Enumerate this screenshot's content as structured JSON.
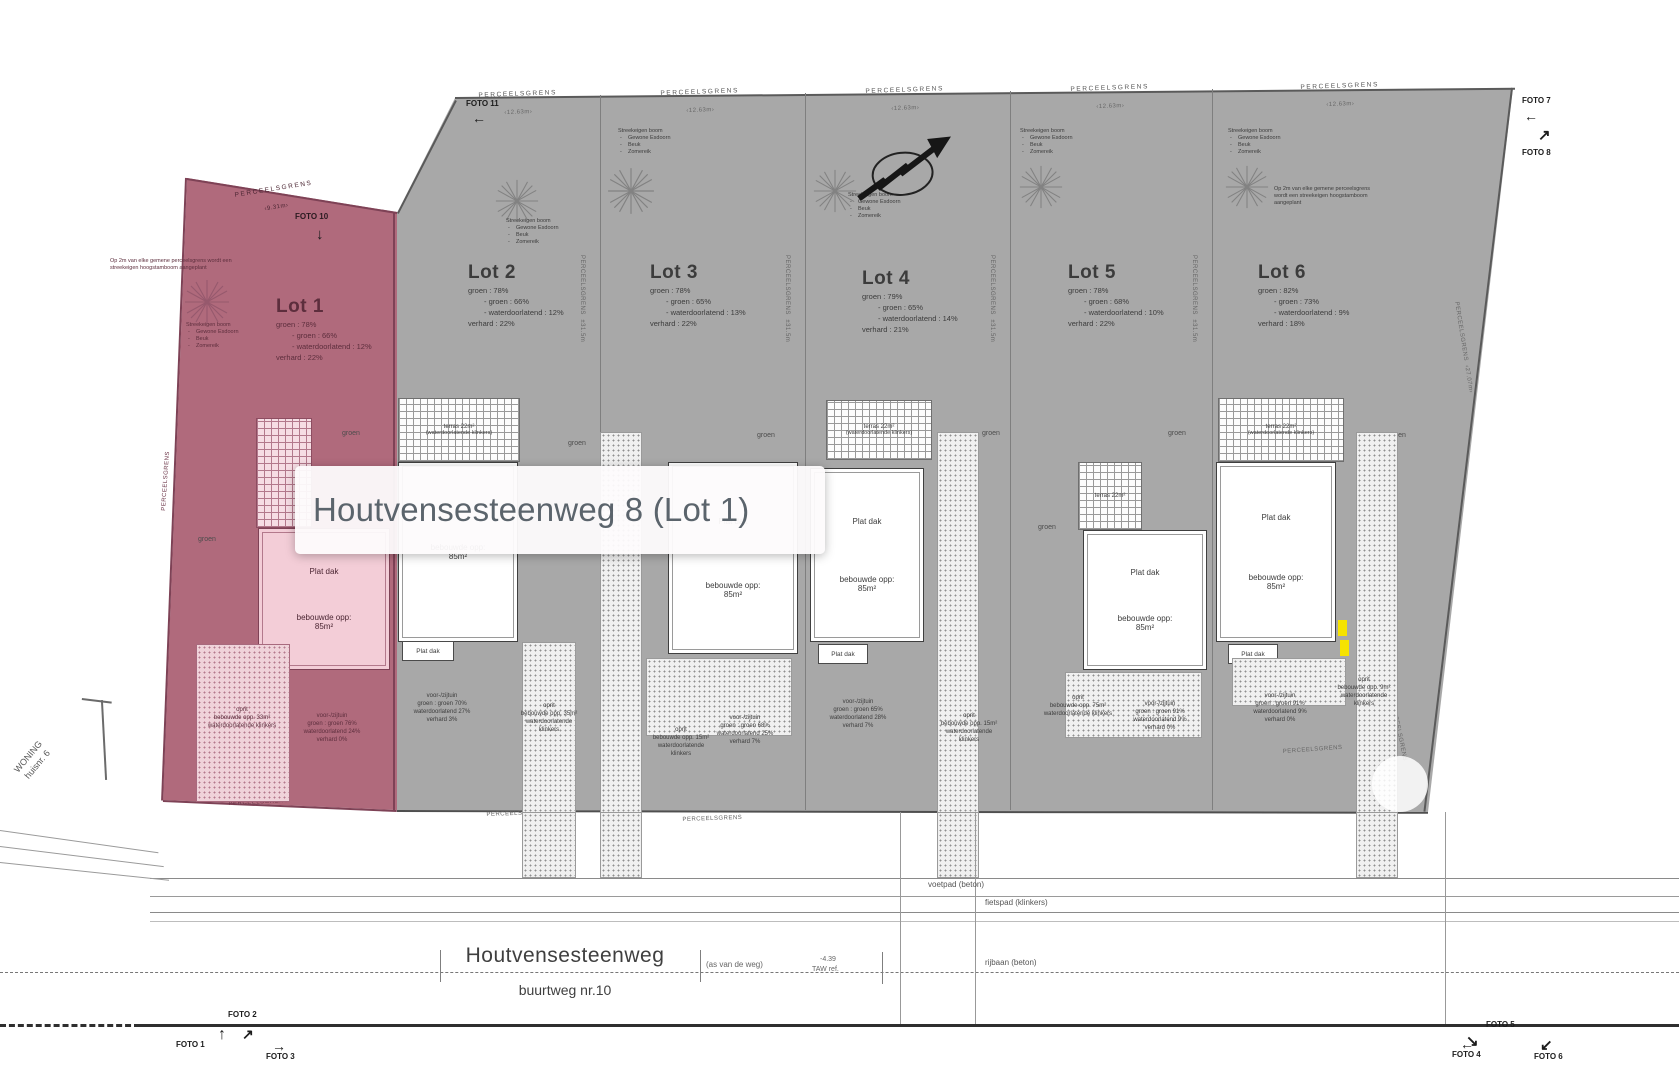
{
  "tooltip": {
    "text": "Houtvensesteenweg 8 (Lot 1)"
  },
  "colors": {
    "lot1_highlight": "#b06a7c",
    "plan_gray": "#a8a8a8",
    "marker_yellow": "#f6e300"
  },
  "plan": {
    "boundary_label": "PERCEELSGRENS",
    "measures": {
      "pink_top": "‹9.31m›",
      "top": "‹12.63m›",
      "right": "‹27.07m›",
      "side": "±31.5m"
    }
  },
  "tree_legend": {
    "title": "Streekeigen boom",
    "items": [
      "Gewone Esdoorn",
      "Beuk",
      "Zomereik"
    ]
  },
  "notes": {
    "lot1": "Op 2m van elke gemene perceelsgrens wordt een streekeigen hoogstamboom aangeplant",
    "lot6": "Op 2m van elke gemene perceelsgrens wordt een streekeigen hoogstamboom aangeplant"
  },
  "neighbor": {
    "line1": "WONING",
    "line2": "huisnr. 6"
  },
  "street": {
    "name": "Houtvensesteenweg",
    "road_type": "buurtweg nr.10",
    "axis": "(as van de weg)",
    "level": "-4.39",
    "level_ref": "TAW ref.",
    "voetpad": "voetpad (beton)",
    "fietspad": "fietspad (klinkers)",
    "rijbaan": "rijbaan (beton)"
  },
  "terras": {
    "label": "terras 22m²",
    "sub": "(waterdoorlatende klinkers)"
  },
  "photos": {
    "f1": "FOTO 1",
    "f2": "FOTO 2",
    "f3": "FOTO 3",
    "f4": "FOTO 4",
    "f5": "FOTO 5",
    "f6": "FOTO 6",
    "f7": "FOTO 7",
    "f8": "FOTO 8",
    "f10": "FOTO 10",
    "f11": "FOTO 11"
  },
  "lots": [
    {
      "label": "Lot 1",
      "stats": [
        "groen : 78%",
        "- groen : 66%",
        "- waterdoorlatend : 12%",
        "verhard : 22%"
      ],
      "house": {
        "roof": "Plat dak",
        "area": "bebouwde opp: 85m²"
      },
      "groen": "groen",
      "front": [
        "voor-/zijtuin",
        "groen : groen 76%",
        "waterdoorlatend 24%",
        "verhard 0%"
      ],
      "oprit": [
        "oprit",
        "bebouwde opp. 33m²",
        "waterdoorlatende klinkers"
      ]
    },
    {
      "label": "Lot 2",
      "stats": [
        "groen : 78%",
        "- groen : 66%",
        "- waterdoorlatend : 12%",
        "verhard : 22%"
      ],
      "house": {
        "roof": "Plat dak",
        "area": "bebouwde opp: 85m²"
      },
      "groen": "groen",
      "front": [
        "voor-/zijtuin",
        "groen : groen 70%",
        "waterdoorlatend 27%",
        "verhard 3%"
      ],
      "oprit": [
        "oprit",
        "bebouwde opp. 35m²",
        "waterdoorlatende klinkers"
      ]
    },
    {
      "label": "Lot 3",
      "stats": [
        "groen : 78%",
        "- groen : 65%",
        "- waterdoorlatend : 13%",
        "verhard : 22%"
      ],
      "house": {
        "roof": "Plat dak",
        "area": "bebouwde opp: 85m²"
      },
      "groen": "groen",
      "front": [
        "voor-/zijtuin",
        "groen : groen 68%",
        "waterdoorlatend 25%",
        "verhard 7%"
      ],
      "oprit": [
        "oprit",
        "bebouwde opp. 15m²",
        "waterdoorlatende klinkers"
      ]
    },
    {
      "label": "Lot 4",
      "stats": [
        "groen : 79%",
        "- groen : 65%",
        "- waterdoorlatend : 14%",
        "verhard : 21%"
      ],
      "house": {
        "roof": "Plat dak",
        "area": "bebouwde opp: 85m²"
      },
      "groen": "groen",
      "front": [
        "voor-/zijtuin",
        "groen : groen 65%",
        "waterdoorlatend 28%",
        "verhard 7%"
      ],
      "oprit": [
        "oprit",
        "bebouwde opp. 15m²",
        "waterdoorlatende klinkers"
      ]
    },
    {
      "label": "Lot 5",
      "stats": [
        "groen : 78%",
        "- groen : 68%",
        "- waterdoorlatend : 10%",
        "verhard : 22%"
      ],
      "house": {
        "roof": "Plat dak",
        "area": "bebouwde opp: 85m²"
      },
      "groen": "groen",
      "front": [
        "voor-/zijtuin",
        "groen : groen 91%",
        "waterdoorlatend 9%",
        "verhard 0%"
      ],
      "oprit": [
        "oprit",
        "bebouwde opp. 75m²",
        "waterdoorlatende klinkers"
      ]
    },
    {
      "label": "Lot 6",
      "stats": [
        "groen : 82%",
        "- groen : 73%",
        "- waterdoorlatend : 9%",
        "verhard : 18%"
      ],
      "house": {
        "roof": "Plat dak",
        "area": "bebouwde opp: 85m²"
      },
      "groen": "groen",
      "front": [
        "voor-/zijtuin",
        "groen : groen 91%",
        "waterdoorlatend 9%",
        "verhard 0%"
      ],
      "oprit": [
        "oprit",
        "bebouwde opp. 9m²",
        "waterdoorlatende klinkers"
      ]
    }
  ]
}
